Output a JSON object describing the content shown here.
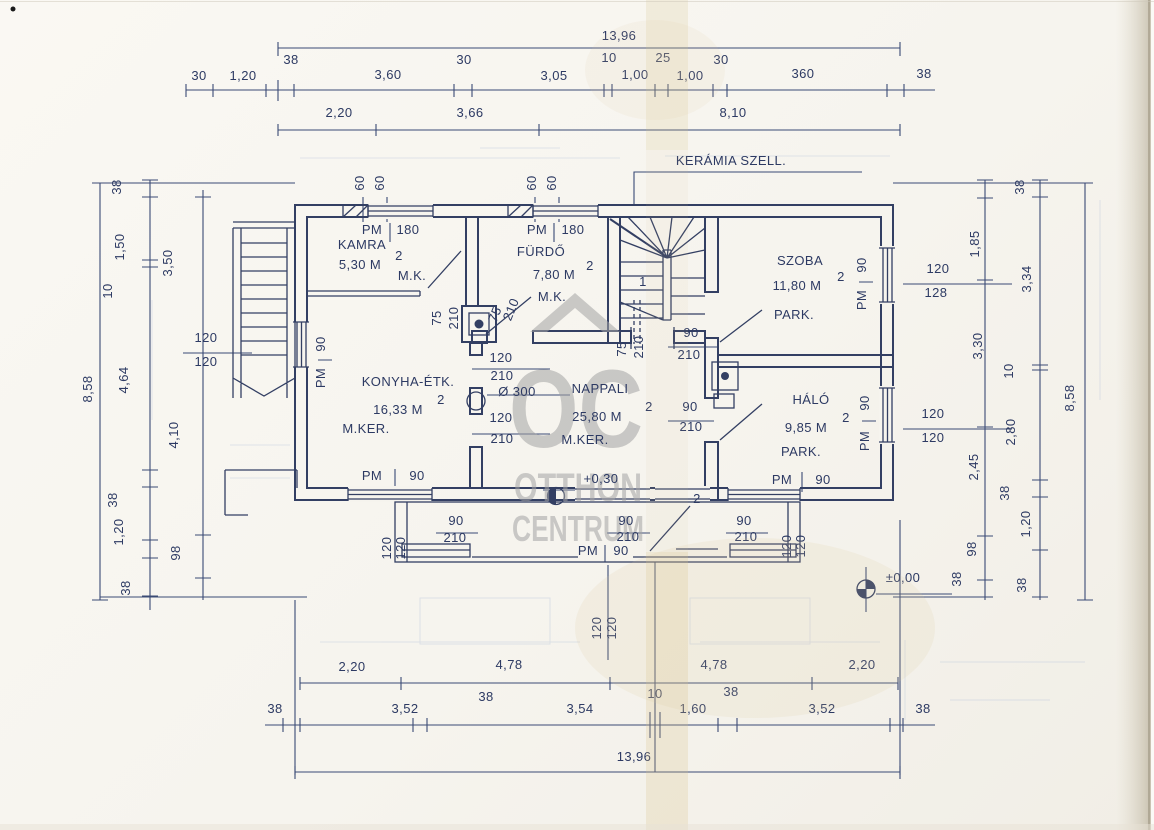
{
  "watermark": {
    "monogram": "OC",
    "line1": "OTTHON",
    "line2": "CENTRUM"
  },
  "texts": [
    {
      "t": "13,96",
      "x": 619,
      "y": 40,
      "n": "dim-total-width-top"
    },
    {
      "t": "30",
      "x": 199,
      "y": 80
    },
    {
      "t": "1,20",
      "x": 243,
      "y": 80
    },
    {
      "t": "38",
      "x": 291,
      "y": 64
    },
    {
      "t": "3,60",
      "x": 388,
      "y": 79
    },
    {
      "t": "30",
      "x": 464,
      "y": 64
    },
    {
      "t": "3,05",
      "x": 554,
      "y": 80
    },
    {
      "t": "10",
      "x": 609,
      "y": 62
    },
    {
      "t": "1,00",
      "x": 635,
      "y": 79
    },
    {
      "t": "25",
      "x": 663,
      "y": 62
    },
    {
      "t": "1,00",
      "x": 690,
      "y": 80
    },
    {
      "t": "30",
      "x": 721,
      "y": 64
    },
    {
      "t": "360",
      "x": 803,
      "y": 78
    },
    {
      "t": "38",
      "x": 924,
      "y": 78
    },
    {
      "t": "2,20",
      "x": 339,
      "y": 117
    },
    {
      "t": "3,66",
      "x": 470,
      "y": 117
    },
    {
      "t": "8,10",
      "x": 733,
      "y": 117
    },
    {
      "t": "60",
      "x": 364,
      "y": 183,
      "r": -90
    },
    {
      "t": "60",
      "x": 384,
      "y": 183,
      "r": -90
    },
    {
      "t": "60",
      "x": 536,
      "y": 183,
      "r": -90
    },
    {
      "t": "60",
      "x": 556,
      "y": 183,
      "r": -90
    },
    {
      "t": "KERÁMIA SZELL.",
      "x": 731,
      "y": 165,
      "ls": 2,
      "n": "vent-label"
    },
    {
      "t": "PM",
      "x": 372,
      "y": 234
    },
    {
      "t": "180",
      "x": 408,
      "y": 234
    },
    {
      "t": "PM",
      "x": 537,
      "y": 234
    },
    {
      "t": "180",
      "x": 573,
      "y": 234
    },
    {
      "t": "KAMRA",
      "x": 362,
      "y": 249,
      "fs": 15,
      "ls": 3,
      "n": "room-name-kamra"
    },
    {
      "t": "5,30 M",
      "x": 360,
      "y": 269,
      "n": "room-area-kamra"
    },
    {
      "t": "2",
      "x": 399,
      "y": 260,
      "fs": 10,
      "n": "sup"
    },
    {
      "t": "M.K.",
      "x": 412,
      "y": 280,
      "n": "room-floor-kamra"
    },
    {
      "t": "FÜRDŐ",
      "x": 541,
      "y": 256,
      "fs": 15,
      "ls": 3,
      "n": "room-name-furdo"
    },
    {
      "t": "7,80 M",
      "x": 554,
      "y": 279,
      "n": "room-area-furdo"
    },
    {
      "t": "2",
      "x": 590,
      "y": 270,
      "fs": 10,
      "n": "sup"
    },
    {
      "t": "M.K.",
      "x": 552,
      "y": 301,
      "n": "room-floor-furdo"
    },
    {
      "t": "SZOBA",
      "x": 800,
      "y": 265,
      "fs": 15,
      "ls": 3,
      "n": "room-name-szoba"
    },
    {
      "t": "11,80 M",
      "x": 797,
      "y": 290,
      "n": "room-area-szoba"
    },
    {
      "t": "2",
      "x": 841,
      "y": 281,
      "fs": 10,
      "n": "sup"
    },
    {
      "t": "PARK.",
      "x": 794,
      "y": 319,
      "n": "room-floor-szoba"
    },
    {
      "t": "KONYHA-ÉTK.",
      "x": 408,
      "y": 386,
      "fs": 15,
      "ls": 2,
      "n": "room-name-konyha"
    },
    {
      "t": "16,33 M",
      "x": 398,
      "y": 414,
      "n": "room-area-konyha"
    },
    {
      "t": "2",
      "x": 441,
      "y": 404,
      "fs": 10,
      "n": "sup"
    },
    {
      "t": "M.KER.",
      "x": 366,
      "y": 433,
      "n": "room-floor-konyha"
    },
    {
      "t": "NAPPALI",
      "x": 600,
      "y": 393,
      "fs": 15,
      "ls": 3,
      "n": "room-name-nappali"
    },
    {
      "t": "25,80 M",
      "x": 597,
      "y": 421,
      "n": "room-area-nappali"
    },
    {
      "t": "2",
      "x": 649,
      "y": 411,
      "fs": 10,
      "n": "sup"
    },
    {
      "t": "M.KER.",
      "x": 585,
      "y": 444,
      "n": "room-floor-nappali"
    },
    {
      "t": "+0,30",
      "x": 601,
      "y": 483,
      "n": "level-plus-030"
    },
    {
      "t": "HÁLÓ",
      "x": 811,
      "y": 404,
      "fs": 15,
      "ls": 3,
      "n": "room-name-halo"
    },
    {
      "t": "9,85 M",
      "x": 806,
      "y": 432,
      "n": "room-area-halo"
    },
    {
      "t": "2",
      "x": 846,
      "y": 422,
      "fs": 10,
      "n": "sup"
    },
    {
      "t": "PARK.",
      "x": 801,
      "y": 456,
      "n": "room-floor-halo"
    },
    {
      "t": "75",
      "x": 441,
      "y": 318,
      "r": -90
    },
    {
      "t": "210",
      "x": 458,
      "y": 318,
      "r": -90
    },
    {
      "t": "75",
      "x": 499,
      "y": 316,
      "r": -68
    },
    {
      "t": "210",
      "x": 515,
      "y": 311,
      "r": -68
    },
    {
      "t": "75",
      "x": 626,
      "y": 349,
      "r": -90
    },
    {
      "t": "210",
      "x": 643,
      "y": 347,
      "r": -90
    },
    {
      "t": "120",
      "x": 501,
      "y": 362
    },
    {
      "t": "210",
      "x": 502,
      "y": 380
    },
    {
      "t": "Ø 300",
      "x": 517,
      "y": 396,
      "n": "column-dim"
    },
    {
      "t": "120",
      "x": 501,
      "y": 422
    },
    {
      "t": "210",
      "x": 502,
      "y": 443
    },
    {
      "t": "90",
      "x": 691,
      "y": 337
    },
    {
      "t": "210",
      "x": 689,
      "y": 359
    },
    {
      "t": "90",
      "x": 690,
      "y": 411
    },
    {
      "t": "210",
      "x": 691,
      "y": 431
    },
    {
      "t": "1",
      "x": 643,
      "y": 286,
      "n": "stair-number"
    },
    {
      "t": "2",
      "x": 697,
      "y": 503,
      "n": "door-number"
    },
    {
      "t": "90",
      "x": 456,
      "y": 525
    },
    {
      "t": "210",
      "x": 455,
      "y": 542
    },
    {
      "t": "90",
      "x": 626,
      "y": 525
    },
    {
      "t": "210",
      "x": 628,
      "y": 541
    },
    {
      "t": "PM",
      "x": 588,
      "y": 555
    },
    {
      "t": "90",
      "x": 621,
      "y": 555
    },
    {
      "t": "90",
      "x": 744,
      "y": 525
    },
    {
      "t": "210",
      "x": 746,
      "y": 541
    },
    {
      "t": "120",
      "x": 391,
      "y": 548,
      "r": -90
    },
    {
      "t": "120",
      "x": 405,
      "y": 548,
      "r": -90
    },
    {
      "t": "120",
      "x": 791,
      "y": 546,
      "r": -90
    },
    {
      "t": "120",
      "x": 805,
      "y": 546,
      "r": -90
    },
    {
      "t": "120",
      "x": 601,
      "y": 628,
      "r": -90
    },
    {
      "t": "120",
      "x": 616,
      "y": 628,
      "r": -90
    },
    {
      "t": "PM",
      "x": 372,
      "y": 480
    },
    {
      "t": "90",
      "x": 417,
      "y": 480
    },
    {
      "t": "PM",
      "x": 782,
      "y": 484
    },
    {
      "t": "90",
      "x": 823,
      "y": 484
    },
    {
      "t": "38",
      "x": 121,
      "y": 187,
      "r": -90
    },
    {
      "t": "1,50",
      "x": 124,
      "y": 247,
      "r": -90
    },
    {
      "t": "10",
      "x": 112,
      "y": 291,
      "r": -90
    },
    {
      "t": "4,64",
      "x": 128,
      "y": 380,
      "r": -90
    },
    {
      "t": "38",
      "x": 117,
      "y": 500,
      "r": -90
    },
    {
      "t": "1,20",
      "x": 123,
      "y": 532,
      "r": -90
    },
    {
      "t": "38",
      "x": 130,
      "y": 588,
      "r": -90
    },
    {
      "t": "3,50",
      "x": 172,
      "y": 263,
      "r": -90
    },
    {
      "t": "4,10",
      "x": 178,
      "y": 435,
      "r": -90
    },
    {
      "t": "98",
      "x": 180,
      "y": 553,
      "r": -90
    },
    {
      "t": "120",
      "x": 206,
      "y": 342
    },
    {
      "t": "120",
      "x": 206,
      "y": 366
    },
    {
      "t": "8,58",
      "x": 92,
      "y": 389,
      "r": -90,
      "n": "dim-total-height-left"
    },
    {
      "t": "90",
      "x": 325,
      "y": 344,
      "r": -90
    },
    {
      "t": "PM",
      "x": 325,
      "y": 378,
      "r": -90
    },
    {
      "t": "90",
      "x": 866,
      "y": 265,
      "r": -90
    },
    {
      "t": "PM",
      "x": 866,
      "y": 300,
      "r": -90
    },
    {
      "t": "120",
      "x": 938,
      "y": 273
    },
    {
      "t": "128",
      "x": 936,
      "y": 297
    },
    {
      "t": "120",
      "x": 933,
      "y": 418
    },
    {
      "t": "120",
      "x": 933,
      "y": 442
    },
    {
      "t": "90",
      "x": 869,
      "y": 403,
      "r": -90
    },
    {
      "t": "PM",
      "x": 869,
      "y": 441,
      "r": -90
    },
    {
      "t": "38",
      "x": 1024,
      "y": 187,
      "r": -90
    },
    {
      "t": "1,85",
      "x": 979,
      "y": 244,
      "r": -90
    },
    {
      "t": "3,34",
      "x": 1031,
      "y": 279,
      "r": -90
    },
    {
      "t": "3,30",
      "x": 982,
      "y": 346,
      "r": -90
    },
    {
      "t": "10",
      "x": 1013,
      "y": 371,
      "r": -90
    },
    {
      "t": "2,80",
      "x": 1015,
      "y": 432,
      "r": -90
    },
    {
      "t": "2,45",
      "x": 978,
      "y": 467,
      "r": -90
    },
    {
      "t": "38",
      "x": 1009,
      "y": 493,
      "r": -90
    },
    {
      "t": "1,20",
      "x": 1030,
      "y": 524,
      "r": -90
    },
    {
      "t": "98",
      "x": 976,
      "y": 549,
      "r": -90
    },
    {
      "t": "38",
      "x": 961,
      "y": 579,
      "r": -90
    },
    {
      "t": "38",
      "x": 1026,
      "y": 585,
      "r": -90
    },
    {
      "t": "8,58",
      "x": 1074,
      "y": 398,
      "r": -90,
      "n": "dim-total-height-right"
    },
    {
      "t": "±0,00",
      "x": 903,
      "y": 582,
      "n": "level-zero"
    },
    {
      "t": "2,20",
      "x": 352,
      "y": 671
    },
    {
      "t": "4,78",
      "x": 509,
      "y": 669
    },
    {
      "t": "4,78",
      "x": 714,
      "y": 669
    },
    {
      "t": "2,20",
      "x": 862,
      "y": 669
    },
    {
      "t": "38",
      "x": 275,
      "y": 713
    },
    {
      "t": "3,52",
      "x": 405,
      "y": 713
    },
    {
      "t": "38",
      "x": 486,
      "y": 701
    },
    {
      "t": "3,54",
      "x": 580,
      "y": 713
    },
    {
      "t": "10",
      "x": 655,
      "y": 698
    },
    {
      "t": "1,60",
      "x": 693,
      "y": 713
    },
    {
      "t": "38",
      "x": 731,
      "y": 696
    },
    {
      "t": "3,52",
      "x": 822,
      "y": 713
    },
    {
      "t": "38",
      "x": 923,
      "y": 713
    },
    {
      "t": "13,96",
      "x": 634,
      "y": 761,
      "n": "dim-total-width-bottom"
    }
  ]
}
